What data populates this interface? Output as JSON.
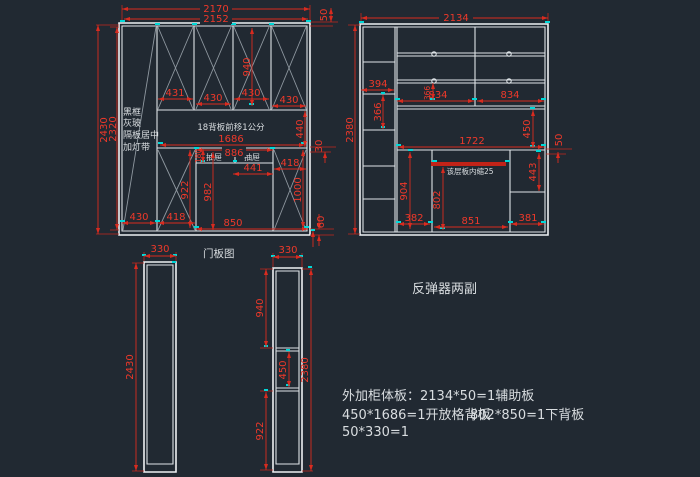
{
  "colors": {
    "background": "#212932",
    "geometry_line": "#dfe4e8",
    "diagonal_line": "#8f98a0",
    "dimension_red": "#d92b1f",
    "highlight_red": "#c22318",
    "grip_cyan": "#00d8d8",
    "cjk_text": "#d9dde0"
  },
  "left_cabinet": {
    "dim_2170": "2170",
    "dim_2152": "2152",
    "dim_50_top": "50",
    "dim_2430": "2430",
    "dim_2320": "2320",
    "door_dim_1": "431",
    "door_dim_2": "430",
    "door_dim_3": "430",
    "door_dim_4": "430",
    "dim_940": "940",
    "note_back_panel": "18背板前移1公分",
    "dim_1686": "1686",
    "dim_440": "440",
    "dim_30": "30",
    "dim_180": "180",
    "drawer_left": "抽屉",
    "drawer_right": "抽屉",
    "dim_886": "886",
    "dim_441": "441",
    "dim_418_mid": "418",
    "dim_922": "922",
    "dim_982": "982",
    "dim_1000": "1000",
    "dim_430_bottom": "430",
    "dim_418_bottom": "418",
    "dim_850": "850",
    "dim_60": "60",
    "side_note_1": "黑框",
    "side_note_2": "灰玻",
    "side_note_3": "隔板居中",
    "side_note_4": "加灯带"
  },
  "right_cabinet": {
    "dim_2134": "2134",
    "dim_2380": "2380",
    "dim_394": "394",
    "dim_366_left": "366",
    "dim_366_shelf": "366",
    "dim_834_left": "834",
    "dim_834_right": "834",
    "dim_1722": "1722",
    "dim_450": "450",
    "dim_50_right": "50",
    "note_shelf_inset": "该层板内缩25",
    "dim_443": "443",
    "dim_904": "904",
    "dim_802": "802",
    "dim_382": "382",
    "dim_851": "851",
    "dim_381": "381"
  },
  "door_panels": {
    "title": "门板图",
    "left_width": "330",
    "left_height": "2430",
    "right_width": "330",
    "right_seg_1": "940",
    "right_seg_2": "450",
    "right_seg_3": "922",
    "right_total": "2380"
  },
  "annotations": {
    "rebound_note": "反弹器两副",
    "note_line_1": "外加柜体板：2134*50=1辅助板",
    "note_line_2a": "450*1686=1开放格背板",
    "note_line_2b": "802*850=1下背板",
    "note_line_3": "50*330=1"
  }
}
